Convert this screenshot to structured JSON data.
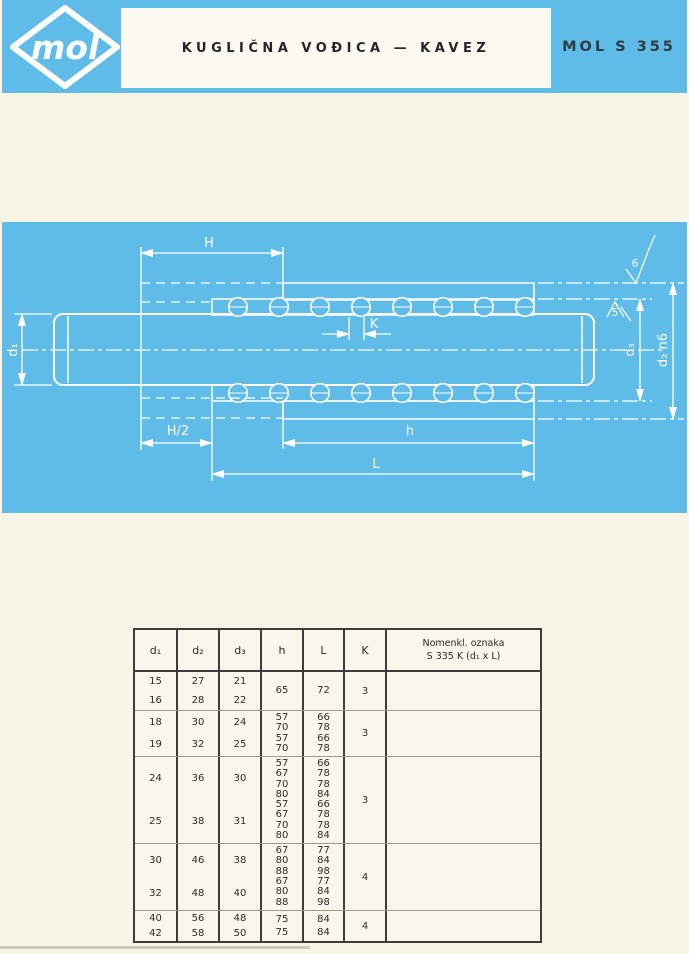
{
  "header": {
    "logo_text": "mol",
    "title": "KUGLIČNA VOĐICA — KAVEZ",
    "model": "MOL S 355"
  },
  "drawing": {
    "labels": {
      "H": "H",
      "H2": "H/2",
      "h": "h",
      "L": "L",
      "K": "K",
      "d1": "d₁",
      "d3": "d₃",
      "d2": "d₂ n6",
      "sf6": "6",
      "sf5": "5"
    }
  },
  "table": {
    "headers": [
      "d₁",
      "d₂",
      "d₃",
      "h",
      "L",
      "K"
    ],
    "nomenkl_header_line1": "Nomenkl. oznaka",
    "nomenkl_header_line2": "S 335 K  (d₁ x L)",
    "groups": [
      {
        "d1": [
          "15",
          "16"
        ],
        "d2": [
          "27",
          "28"
        ],
        "d3": [
          "21",
          "22"
        ],
        "h": [
          "65"
        ],
        "L": [
          "72"
        ],
        "K": "3"
      },
      {
        "d1": [
          "18",
          "19"
        ],
        "d2": [
          "30",
          "32"
        ],
        "d3": [
          "24",
          "25"
        ],
        "h": [
          "57",
          "70",
          "57",
          "70"
        ],
        "L": [
          "66",
          "78",
          "66",
          "78"
        ],
        "K": "3"
      },
      {
        "d1": [
          "24",
          "25"
        ],
        "d2": [
          "36",
          "38"
        ],
        "d3": [
          "30",
          "31"
        ],
        "h": [
          "57",
          "67",
          "70",
          "80",
          "57",
          "67",
          "70",
          "80"
        ],
        "L": [
          "66",
          "78",
          "78",
          "84",
          "66",
          "78",
          "78",
          "84"
        ],
        "K": "3"
      },
      {
        "d1": [
          "30",
          "32"
        ],
        "d2": [
          "46",
          "48"
        ],
        "d3": [
          "38",
          "40"
        ],
        "h": [
          "67",
          "80",
          "88",
          "67",
          "80",
          "88"
        ],
        "L": [
          "77",
          "84",
          "98",
          "77",
          "84",
          "98"
        ],
        "K": "4"
      },
      {
        "d1": [
          "40",
          "42"
        ],
        "d2": [
          "56",
          "58"
        ],
        "d3": [
          "48",
          "50"
        ],
        "h": [
          "75",
          "75"
        ],
        "L": [
          "84",
          "84"
        ],
        "K": "4"
      }
    ]
  },
  "colors": {
    "panel_blue": "#5fbce8",
    "paper": "#f8f5e7",
    "drawing_line": "#ffffff",
    "table_line": "#3d3d3d",
    "text": "#2b2b2b"
  }
}
